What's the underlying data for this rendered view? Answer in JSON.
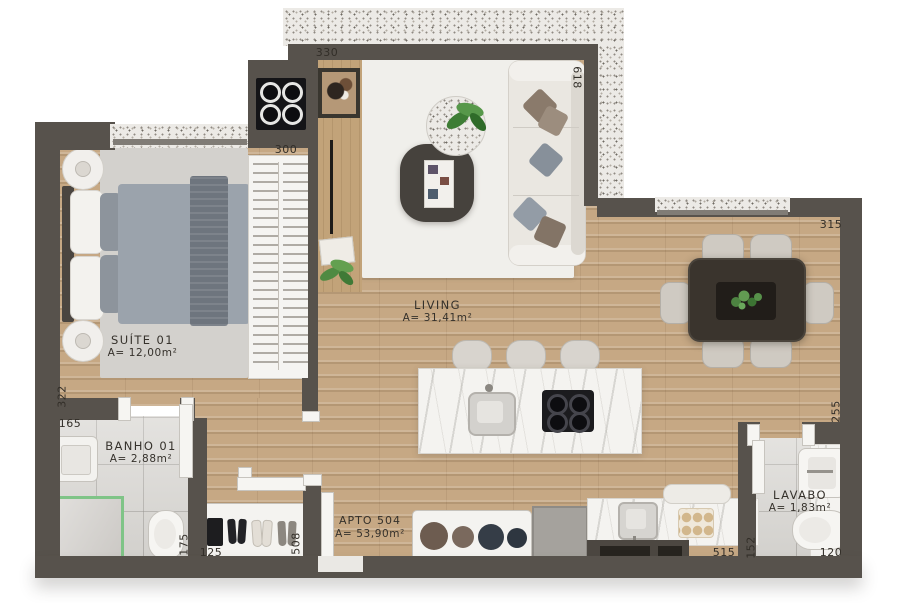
{
  "title": "APTO 504",
  "rooms": {
    "suite": {
      "name": "SUÍTE 01",
      "area": "A= 12,00m²"
    },
    "banho": {
      "name": "BANHO 01",
      "area": "A= 2,88m²"
    },
    "living": {
      "name": "LIVING",
      "area": "A= 31,41m²"
    },
    "apto": {
      "name": "APTO 504",
      "area": "A= 53,90m²"
    },
    "lavabo": {
      "name": "LAVABO",
      "area": "A= 1,83m²"
    }
  },
  "dimensions": {
    "top_width": "330",
    "living_right_height": "618",
    "closet_width": "300",
    "dining_top_width": "315",
    "suite_left_height": "322",
    "banho_top_width": "165",
    "banho_door_height": "175",
    "hall_bottom_width": "125",
    "hall_depth": "508",
    "kitchen_bottom_width": "515",
    "lavabo_left_height": "152",
    "lavabo_bottom_width": "120",
    "dining_right_height": "255"
  },
  "colors": {
    "wall": "#57524c",
    "wood_floor": "#c6a884",
    "tile_floor": "#dbd9d5",
    "masonry_speckle": "#eceae6",
    "marble": "#f4f3f0",
    "shower_glass_accent": "#7fc487",
    "duvet_gray": "#9ba3ac",
    "sofa_ivory": "#eae7e1",
    "dining_table_dark": "#3a342d"
  }
}
